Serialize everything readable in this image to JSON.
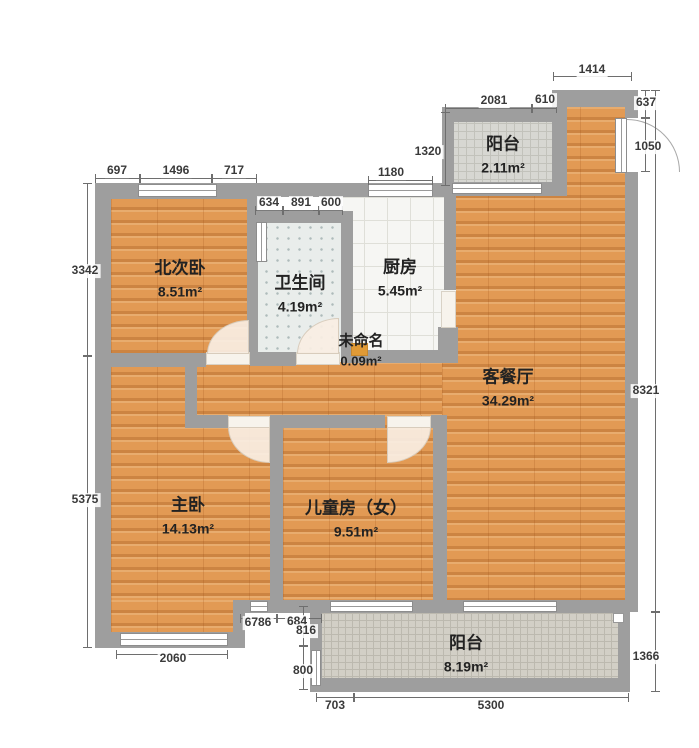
{
  "floorplan": {
    "rooms": [
      {
        "id": "north-bedroom",
        "name": "北次卧",
        "area": "8.51m²"
      },
      {
        "id": "bathroom",
        "name": "卫生间",
        "area": "4.19m²"
      },
      {
        "id": "kitchen",
        "name": "厨房",
        "area": "5.45m²"
      },
      {
        "id": "balcony-top",
        "name": "阳台",
        "area": "2.11m²"
      },
      {
        "id": "unnamed",
        "name": "未命名",
        "area": "0.09m²"
      },
      {
        "id": "living-dining",
        "name": "客餐厅",
        "area": "34.29m²"
      },
      {
        "id": "master-bedroom",
        "name": "主卧",
        "area": "14.13m²"
      },
      {
        "id": "kids-room",
        "name": "儿童房（女）",
        "area": "9.51m²"
      },
      {
        "id": "balcony-bottom",
        "name": "阳台",
        "area": "8.19m²"
      }
    ],
    "dimensions": {
      "bedroom_top": [
        "697",
        "1496",
        "717"
      ],
      "bath_top": [
        "634",
        "891",
        "600"
      ],
      "kitchen_top": "1180",
      "balcony_top_height": "1320",
      "balcony_top_width": [
        "2081",
        "610"
      ],
      "entry_top": "1414",
      "right_side": [
        "637",
        "1050",
        "8321",
        "1366"
      ],
      "left_side": [
        "3342",
        "5375"
      ],
      "bottom_side": [
        "2060",
        "6786",
        "684",
        "816",
        "800",
        "703",
        "5300"
      ]
    },
    "colors": {
      "wall": "#9e9e9e",
      "wood_floor": "#e29a54",
      "tile_light": "#e9edeb",
      "accent_square": "#e09a36"
    }
  }
}
